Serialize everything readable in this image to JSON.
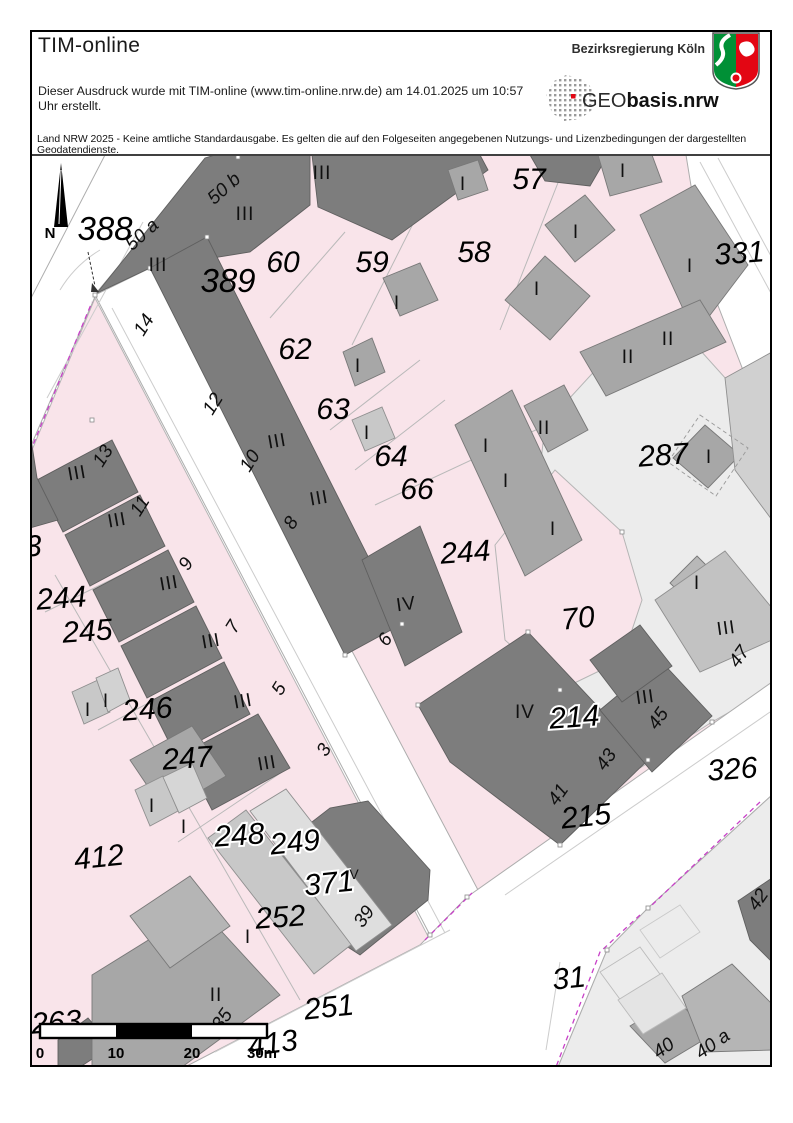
{
  "header": {
    "app_title": "TIM-online",
    "printout_line1": "Dieser Ausdruck wurde mit TIM-online (www.tim-online.nrw.de) am 14.01.2025 um 10:57",
    "printout_line2": "Uhr erstellt.",
    "agency": "Bezirksregierung Köln",
    "logo_geo_light": "GEO",
    "logo_geo_bold": "basis.nrw",
    "disclaimer": "Land NRW 2025 - Keine amtliche Standardausgabe. Es gelten die auf den Folgeseiten angegebenen Nutzungs- und Lizenzbedingungen der dargestellten Geodatendienste."
  },
  "map": {
    "colors": {
      "parcel_pink": "#f9e4ea",
      "parcel_light_gray": "#ececec",
      "building_dark": "#7d7d7d",
      "building_medium": "#a7a7a7",
      "building_light": "#c8c8c8",
      "road_white": "#ffffff",
      "boundary_magenta": "#c840c8",
      "nrw_green": "#009036",
      "nrw_red": "#e30613"
    },
    "scale_bar": {
      "unit": "m",
      "segments": [
        0,
        10,
        20,
        30
      ]
    },
    "labels": [
      {
        "t": "388",
        "x": 105,
        "y": 240,
        "c": "pl"
      },
      {
        "t": "389",
        "x": 228,
        "y": 292,
        "c": "pl"
      },
      {
        "t": "60",
        "x": 283,
        "y": 272,
        "c": "p"
      },
      {
        "t": "59",
        "x": 372,
        "y": 272,
        "c": "p"
      },
      {
        "t": "57",
        "x": 529,
        "y": 189,
        "c": "p"
      },
      {
        "t": "58",
        "x": 474,
        "y": 262,
        "c": "p"
      },
      {
        "t": "331",
        "x": 740,
        "y": 263,
        "c": "p",
        "r": -4
      },
      {
        "t": "62",
        "x": 295,
        "y": 359,
        "c": "p"
      },
      {
        "t": "63",
        "x": 333,
        "y": 419,
        "c": "p"
      },
      {
        "t": "64",
        "x": 391,
        "y": 466,
        "c": "p"
      },
      {
        "t": "66",
        "x": 417,
        "y": 499,
        "c": "p"
      },
      {
        "t": "287",
        "x": 664,
        "y": 465,
        "c": "p",
        "r": -4
      },
      {
        "t": "244",
        "x": 466,
        "y": 562,
        "c": "p",
        "r": -4
      },
      {
        "t": "244",
        "x": 62,
        "y": 608,
        "c": "p",
        "r": -4
      },
      {
        "t": "245",
        "x": 88,
        "y": 641,
        "c": "p",
        "r": -4
      },
      {
        "t": "70",
        "x": 579,
        "y": 628,
        "c": "p",
        "r": -6
      },
      {
        "t": "246",
        "x": 148,
        "y": 719,
        "c": "p",
        "r": -4
      },
      {
        "t": "247",
        "x": 188,
        "y": 768,
        "c": "p",
        "r": -4
      },
      {
        "t": "412",
        "x": 100,
        "y": 867,
        "c": "p",
        "r": -6
      },
      {
        "t": "214",
        "x": 575,
        "y": 727,
        "c": "ph",
        "r": -4
      },
      {
        "t": "215",
        "x": 587,
        "y": 826,
        "c": "p",
        "r": -6
      },
      {
        "t": "326",
        "x": 733,
        "y": 779,
        "c": "p",
        "r": -4
      },
      {
        "t": "248",
        "x": 240,
        "y": 845,
        "c": "ph",
        "r": -4
      },
      {
        "t": "249",
        "x": 296,
        "y": 852,
        "c": "ph",
        "r": -6
      },
      {
        "t": "371",
        "x": 330,
        "y": 893,
        "c": "ph",
        "r": -6
      },
      {
        "t": "252",
        "x": 281,
        "y": 927,
        "c": "p",
        "r": -4
      },
      {
        "t": "251",
        "x": 330,
        "y": 1017,
        "c": "p",
        "r": -6
      },
      {
        "t": "263",
        "x": 57,
        "y": 1032,
        "c": "p",
        "r": -4
      },
      {
        "t": "413",
        "x": 274,
        "y": 1053,
        "c": "p",
        "r": -8
      },
      {
        "t": "31",
        "x": 570,
        "y": 988,
        "c": "p",
        "r": -6
      },
      {
        "t": "3",
        "x": 34,
        "y": 556,
        "c": "p",
        "r": -4
      },
      {
        "t": "III",
        "x": 322,
        "y": 179,
        "c": "r"
      },
      {
        "t": "III",
        "x": 245,
        "y": 220,
        "c": "r"
      },
      {
        "t": "III",
        "x": 158,
        "y": 271,
        "c": "r"
      },
      {
        "t": "III",
        "x": 278,
        "y": 447,
        "c": "r",
        "r": -10
      },
      {
        "t": "III",
        "x": 320,
        "y": 504,
        "c": "r",
        "r": -10
      },
      {
        "t": "III",
        "x": 78,
        "y": 479,
        "c": "r",
        "r": -10
      },
      {
        "t": "III",
        "x": 118,
        "y": 526,
        "c": "r",
        "r": -10
      },
      {
        "t": "III",
        "x": 170,
        "y": 589,
        "c": "r",
        "r": -10
      },
      {
        "t": "III",
        "x": 212,
        "y": 647,
        "c": "r",
        "r": -10
      },
      {
        "t": "III",
        "x": 244,
        "y": 707,
        "c": "r",
        "r": -10
      },
      {
        "t": "III",
        "x": 268,
        "y": 769,
        "c": "r",
        "r": -10
      },
      {
        "t": "I",
        "x": 463,
        "y": 190,
        "c": "r"
      },
      {
        "t": "I",
        "x": 576,
        "y": 238,
        "c": "r"
      },
      {
        "t": "I",
        "x": 623,
        "y": 177,
        "c": "r"
      },
      {
        "t": "I",
        "x": 690,
        "y": 272,
        "c": "r"
      },
      {
        "t": "I",
        "x": 397,
        "y": 309,
        "c": "r"
      },
      {
        "t": "I",
        "x": 358,
        "y": 372,
        "c": "r"
      },
      {
        "t": "I",
        "x": 367,
        "y": 439,
        "c": "r"
      },
      {
        "t": "I",
        "x": 537,
        "y": 295,
        "c": "r"
      },
      {
        "t": "I",
        "x": 486,
        "y": 452,
        "c": "r"
      },
      {
        "t": "I",
        "x": 506,
        "y": 487,
        "c": "r"
      },
      {
        "t": "I",
        "x": 553,
        "y": 535,
        "c": "r"
      },
      {
        "t": "II",
        "x": 628,
        "y": 363,
        "c": "r"
      },
      {
        "t": "II",
        "x": 668,
        "y": 345,
        "c": "r"
      },
      {
        "t": "II",
        "x": 544,
        "y": 434,
        "c": "r"
      },
      {
        "t": "I",
        "x": 709,
        "y": 463,
        "c": "r"
      },
      {
        "t": "I",
        "x": 697,
        "y": 589,
        "c": "r"
      },
      {
        "t": "III",
        "x": 727,
        "y": 634,
        "c": "r",
        "r": -8
      },
      {
        "t": "47",
        "x": 744,
        "y": 660,
        "c": "h",
        "r": -55
      },
      {
        "t": "III",
        "x": 646,
        "y": 703,
        "c": "r",
        "r": -8
      },
      {
        "t": "45",
        "x": 663,
        "y": 722,
        "c": "h",
        "r": -55
      },
      {
        "t": "43",
        "x": 611,
        "y": 763,
        "c": "h",
        "r": -55
      },
      {
        "t": "41",
        "x": 563,
        "y": 798,
        "c": "h",
        "r": -55
      },
      {
        "t": "IV",
        "x": 525,
        "y": 718,
        "c": "r"
      },
      {
        "t": "IV",
        "x": 407,
        "y": 610,
        "c": "r",
        "r": -8
      },
      {
        "t": "6",
        "x": 390,
        "y": 643,
        "c": "h",
        "r": -55
      },
      {
        "t": "V",
        "x": 354,
        "y": 879,
        "c": "rs"
      },
      {
        "t": "39",
        "x": 369,
        "y": 920,
        "c": "h",
        "r": -55
      },
      {
        "t": "I",
        "x": 248,
        "y": 943,
        "c": "r"
      },
      {
        "t": "II",
        "x": 216,
        "y": 1001,
        "c": "r"
      },
      {
        "t": "35",
        "x": 227,
        "y": 1023,
        "c": "h",
        "r": -55
      },
      {
        "t": "I",
        "x": 152,
        "y": 812,
        "c": "r"
      },
      {
        "t": "I",
        "x": 184,
        "y": 833,
        "c": "r"
      },
      {
        "t": "I",
        "x": 88,
        "y": 716,
        "c": "r"
      },
      {
        "t": "I",
        "x": 106,
        "y": 707,
        "c": "r"
      },
      {
        "t": "50 a",
        "x": 146,
        "y": 239,
        "c": "h",
        "r": -42
      },
      {
        "t": "50 b",
        "x": 228,
        "y": 193,
        "c": "h",
        "r": -42
      },
      {
        "t": "14",
        "x": 149,
        "y": 328,
        "c": "h",
        "r": -58
      },
      {
        "t": "12",
        "x": 218,
        "y": 407,
        "c": "h",
        "r": -58
      },
      {
        "t": "10",
        "x": 255,
        "y": 464,
        "c": "h",
        "r": -58
      },
      {
        "t": "8",
        "x": 296,
        "y": 526,
        "c": "h",
        "r": -58
      },
      {
        "t": "13",
        "x": 108,
        "y": 459,
        "c": "h",
        "r": -58
      },
      {
        "t": "11",
        "x": 145,
        "y": 509,
        "c": "h",
        "r": -58
      },
      {
        "t": "9",
        "x": 191,
        "y": 567,
        "c": "h",
        "r": -58
      },
      {
        "t": "7",
        "x": 238,
        "y": 630,
        "c": "h",
        "r": -58
      },
      {
        "t": "5",
        "x": 284,
        "y": 692,
        "c": "h",
        "r": -58
      },
      {
        "t": "3",
        "x": 329,
        "y": 753,
        "c": "h",
        "r": -58
      },
      {
        "t": "40",
        "x": 667,
        "y": 1053,
        "c": "h",
        "r": -35
      },
      {
        "t": "40 a",
        "x": 716,
        "y": 1049,
        "c": "h",
        "r": -35
      },
      {
        "t": "42",
        "x": 763,
        "y": 903,
        "c": "h",
        "r": -55
      },
      {
        "t": "0",
        "x": 40,
        "y": 1058,
        "c": "sc"
      },
      {
        "t": "10",
        "x": 116,
        "y": 1058,
        "c": "sc"
      },
      {
        "t": "20",
        "x": 192,
        "y": 1058,
        "c": "sc"
      },
      {
        "t": "30m",
        "x": 262,
        "y": 1058,
        "c": "sc"
      },
      {
        "t": "N",
        "x": 50,
        "y": 238,
        "c": "n"
      }
    ]
  }
}
